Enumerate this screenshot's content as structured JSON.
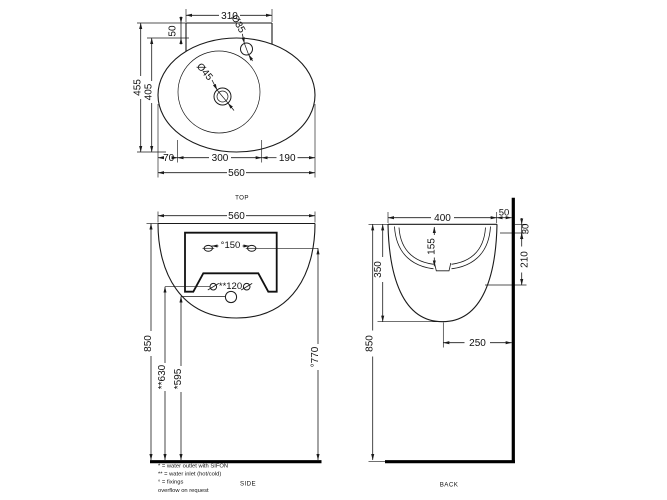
{
  "views": {
    "top": {
      "label": "TOP",
      "d310": "310",
      "d50": "50",
      "d35": "Ø35",
      "d45": "Ø45",
      "d455": "455",
      "d405": "405",
      "d70": "70",
      "d300": "300",
      "d190": "190",
      "d560": "560"
    },
    "side": {
      "label": "SIDE",
      "d560": "560",
      "d150": "°150",
      "d120": "**120",
      "d850": "850",
      "d630": "**630",
      "d595": "*595",
      "d770": "°770"
    },
    "back": {
      "label": "BACK",
      "d400": "400",
      "d50": "50",
      "d30": "30",
      "d210": "210",
      "d155": "155",
      "d350": "350",
      "d850": "850",
      "d250": "250"
    }
  },
  "footnotes": {
    "outlet": "* = water outlet with SIFON",
    "inlet": "** = water inlet (hot/cold)",
    "fixings": "° = fixings",
    "overflow": "overflow on request"
  },
  "colors": {
    "line": "#1a1a1a",
    "heavy": "#000000",
    "background": "#ffffff"
  }
}
